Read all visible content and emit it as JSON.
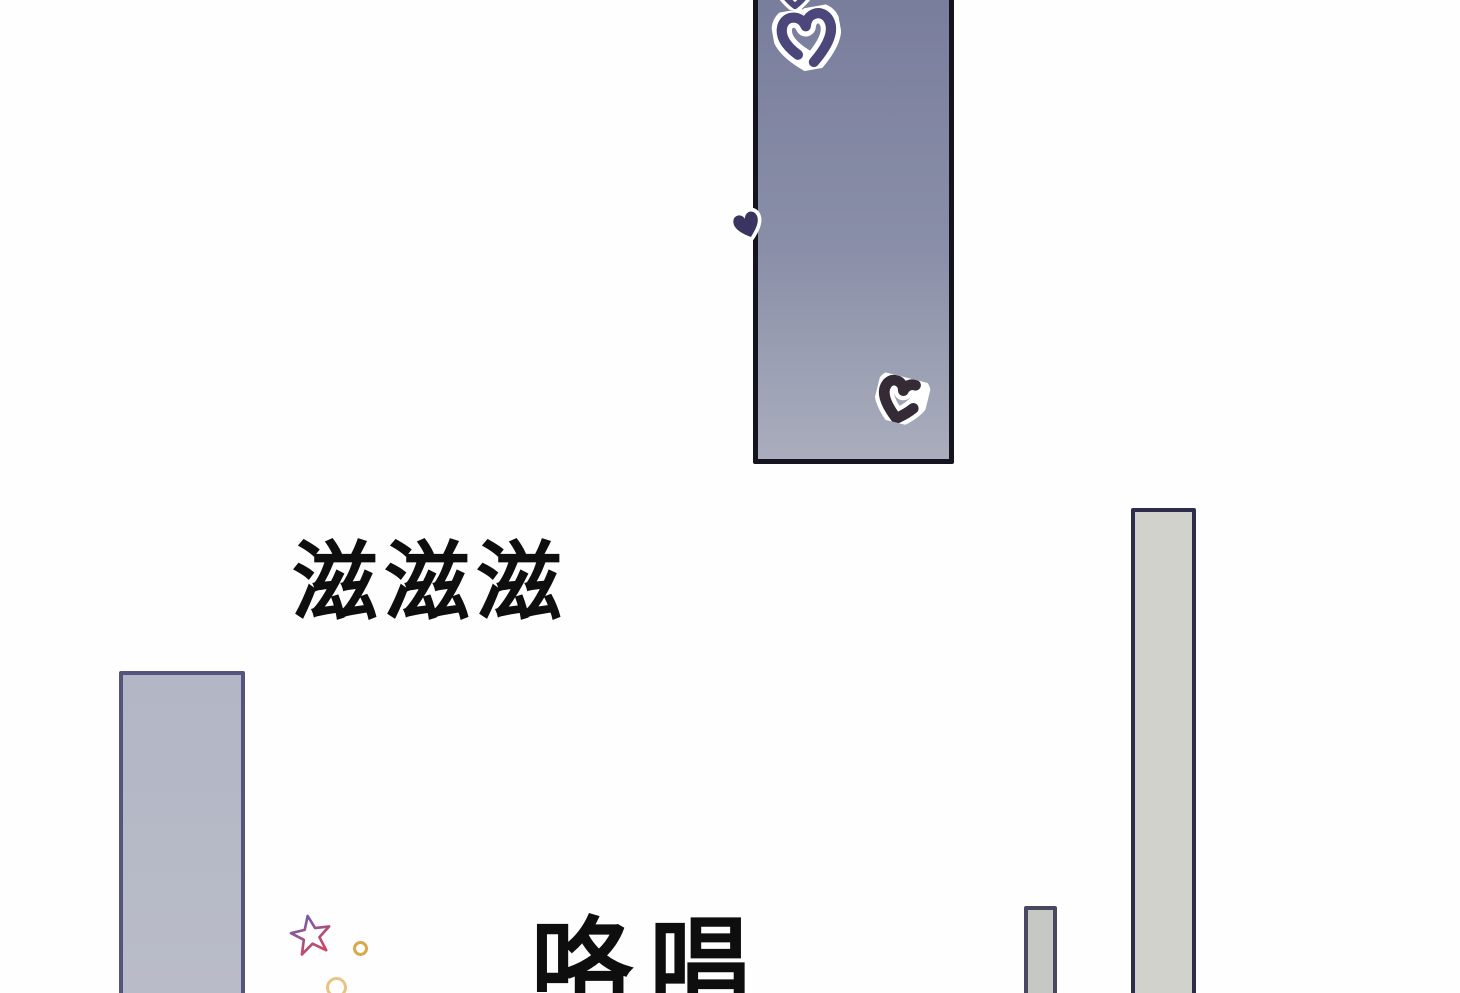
{
  "page": {
    "type": "webtoon-comic-segment",
    "background": "#fefefe",
    "width": 1460,
    "height": 993
  },
  "sfx": {
    "sizzle": "滋滋滋",
    "bottom_partial": "咯唱"
  },
  "panels": {
    "top": {
      "fill_top": "#787d9c",
      "fill_bottom": "#a9adbc",
      "border": "#14141f"
    },
    "left": {
      "fill": "#b5b9c6",
      "border": "#54547e"
    },
    "right": {
      "fill": "#d0d2cb",
      "border": "#2e2d4e"
    },
    "small_bar": {
      "fill": "#c5c8c3",
      "border": "#494861"
    }
  },
  "doodles": {
    "heart_top_partial": {
      "color": "#4b477a",
      "outline": "#ffffff"
    },
    "heart_large": {
      "color": "#4b477a",
      "outline": "#ffffff"
    },
    "heart_edge_small": {
      "color": "#3a3560",
      "outline": "#ffffff"
    },
    "heart_bottom_right": {
      "color": "#342b36",
      "outline": "#ffffff"
    },
    "star": {
      "color_top": "#6660b2",
      "color_bottom": "#c9486a"
    },
    "sparkle_1_color": "#d8a94e",
    "sparkle_2_color": "#e9c386"
  }
}
